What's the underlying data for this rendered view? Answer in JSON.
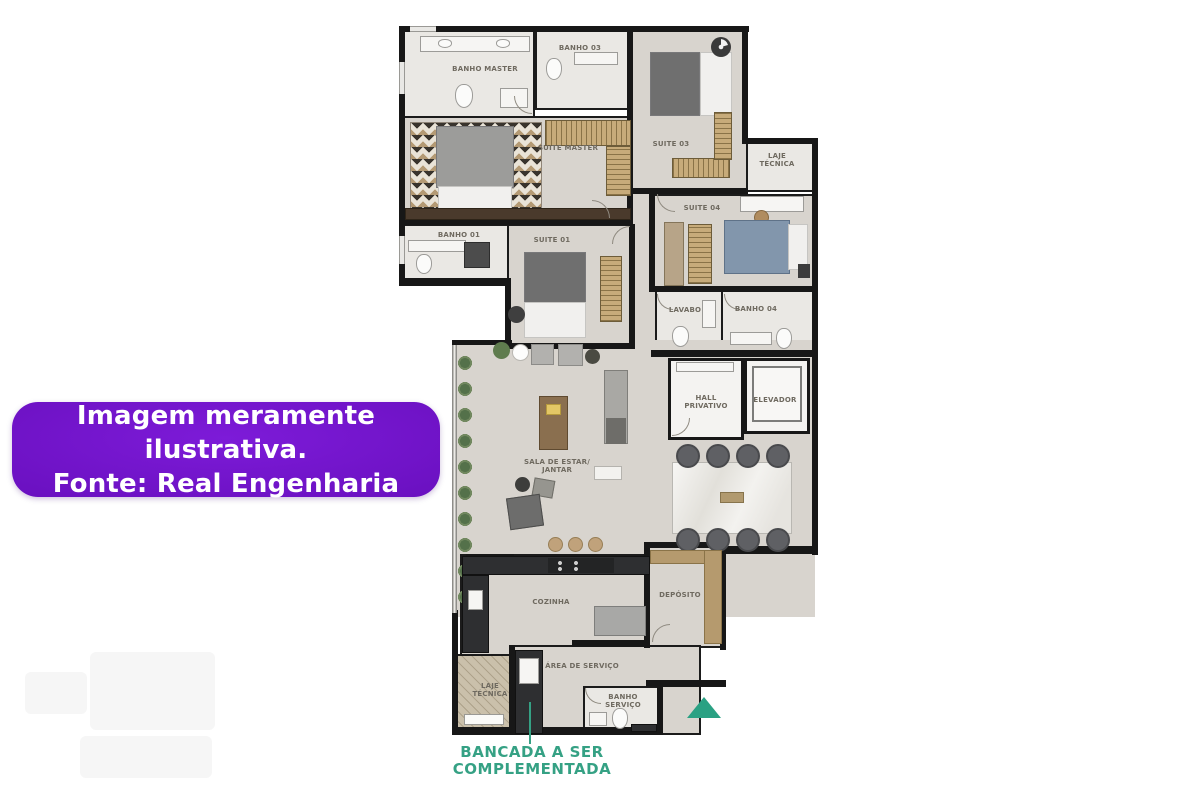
{
  "banner": {
    "line1": "Imagem meramente ilustrativa.",
    "line2": "Fonte: Real Engenharia"
  },
  "callout": {
    "line1": "BANCADA A SER",
    "line2": "COMPLEMENTADA"
  },
  "rooms": {
    "banho_master": {
      "label": "BANHO MASTER"
    },
    "banho_03": {
      "label": "BANHO 03"
    },
    "suite_master": {
      "label": "SUITE MASTER"
    },
    "suite_03": {
      "label": "SUITE 03"
    },
    "laje_tecnica_top": {
      "line1": "LAJE",
      "line2": "TÉCNICA"
    },
    "suite_04": {
      "label": "SUITE 04"
    },
    "banho_01": {
      "label": "BANHO 01"
    },
    "suite_01": {
      "label": "SUITE 01"
    },
    "lavabo": {
      "label": "LAVABO"
    },
    "banho_04": {
      "label": "BANHO 04"
    },
    "hall_privativo": {
      "line1": "HALL",
      "line2": "PRIVATIVO"
    },
    "elevador": {
      "label": "ELEVADOR"
    },
    "sala": {
      "line1": "SALA DE ESTAR/",
      "line2": "JANTAR"
    },
    "cozinha": {
      "label": "COZINHA"
    },
    "deposito": {
      "label": "DEPÓSITO"
    },
    "area_servico": {
      "label": "ÁREA DE SERVIÇO"
    },
    "laje_tecnica_bottom": {
      "line1": "LAJE",
      "line2": "TÉCNICA"
    },
    "banho_servico": {
      "line1": "BANHO",
      "line2": "SERVIÇO"
    }
  },
  "icons": {
    "north_arrow": "north-arrow",
    "ceiling_fan": "ceiling-fan-icon"
  },
  "colors": {
    "banner_purple": "#6a10c0",
    "accent_green": "#2fa183",
    "wall_black": "#171717",
    "floor_beige": "#d8d4ce",
    "wood_tan": "#c7ab7a",
    "bed_blue": "#8296ac"
  }
}
